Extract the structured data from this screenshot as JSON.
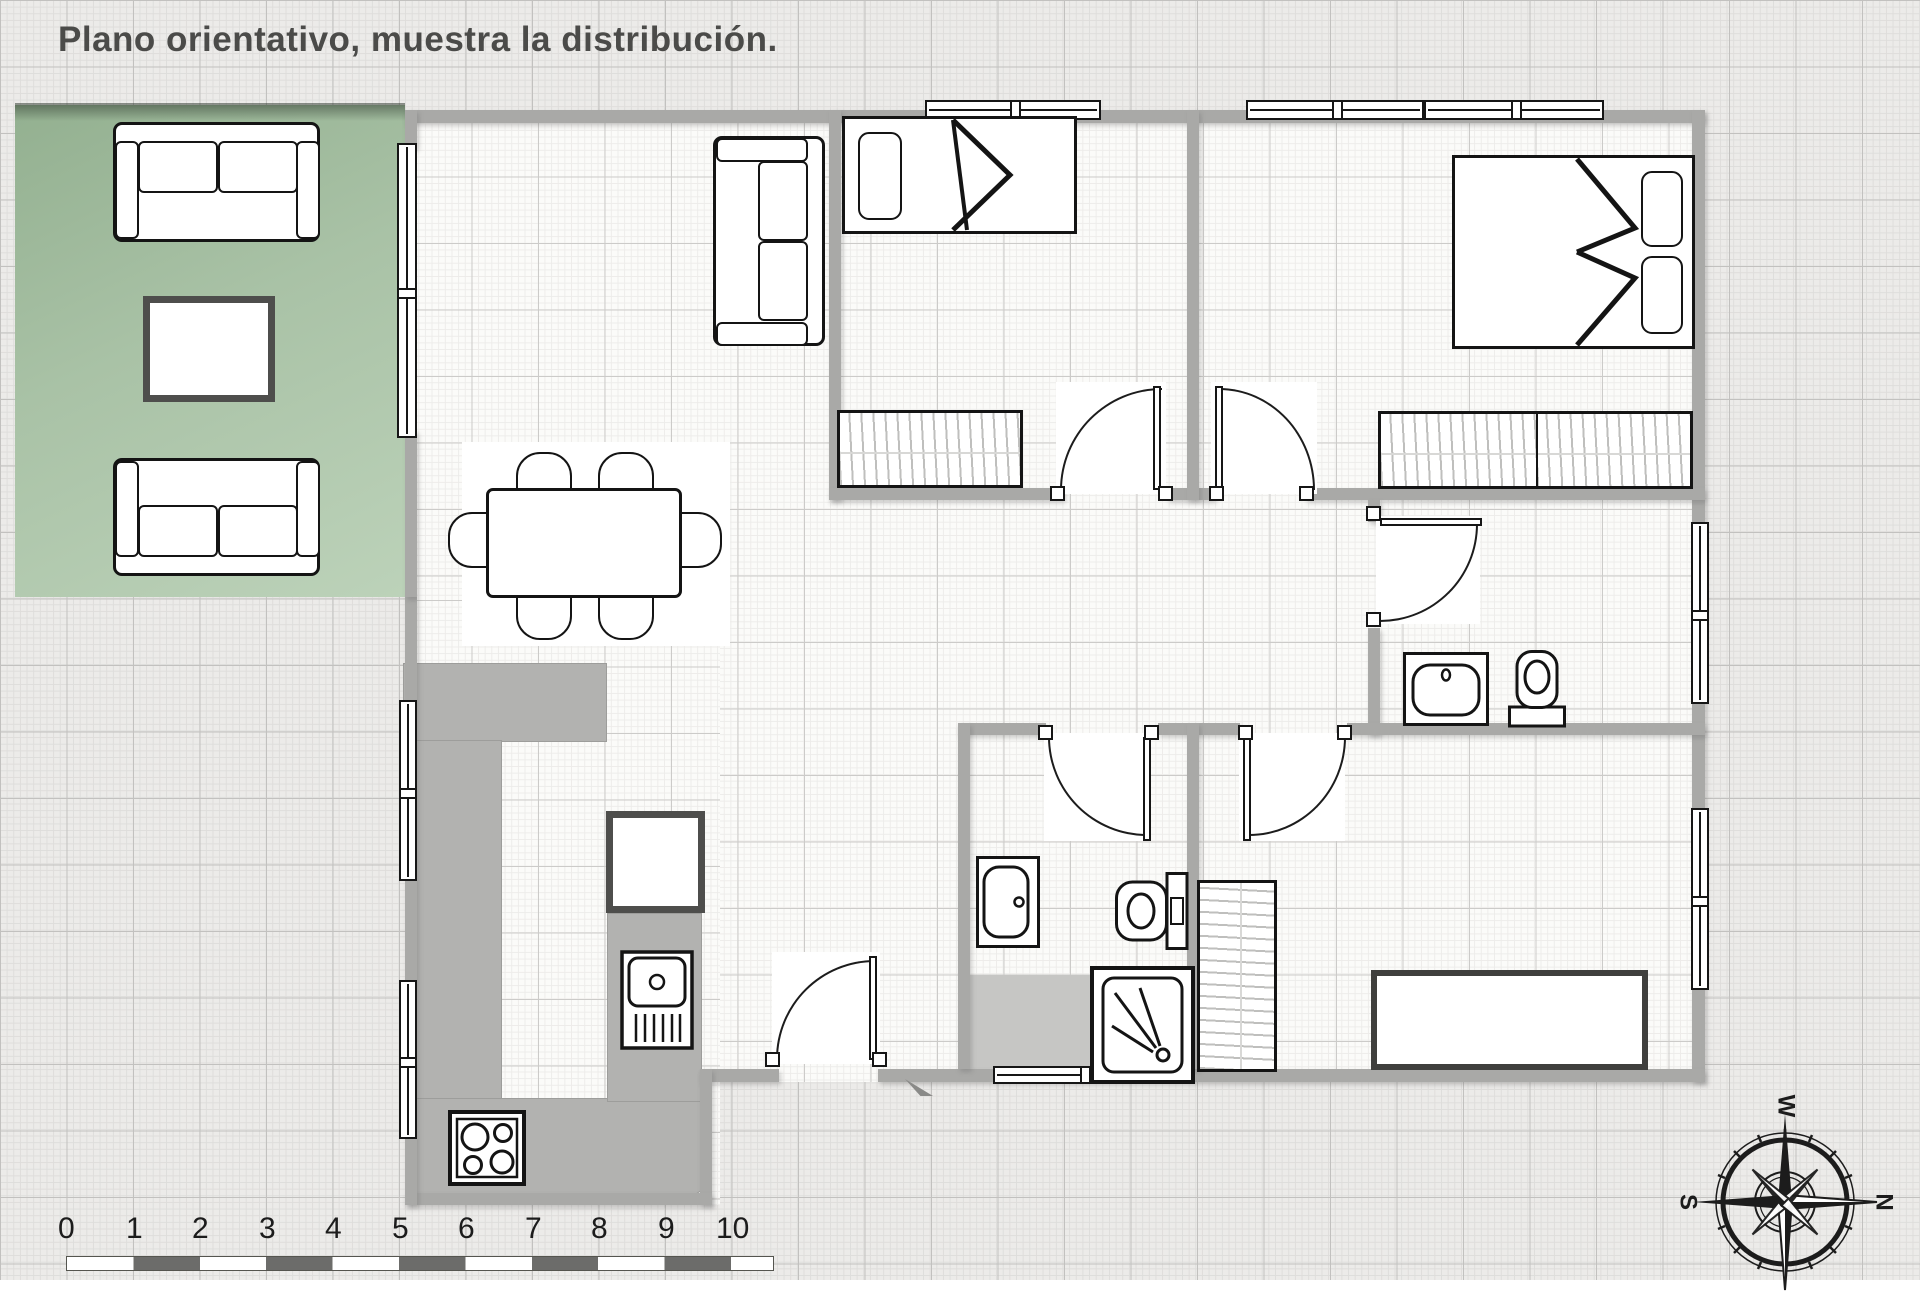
{
  "title": "Plano orientativo, muestra la distribución.",
  "ruler": {
    "labels": [
      "0",
      "1",
      "2",
      "3",
      "4",
      "5",
      "6",
      "7",
      "8",
      "9",
      "10"
    ]
  },
  "compass": {
    "top": "W",
    "left": "S",
    "right": "N"
  },
  "colors": {
    "terrace_green": "#a9c2a6",
    "wall_gray": "#a9a9a7",
    "counter_gray": "#b2b2b0",
    "paper": "#ecebe9",
    "ink": "#1a1a1a",
    "dark_border": "#4e4e4c"
  }
}
